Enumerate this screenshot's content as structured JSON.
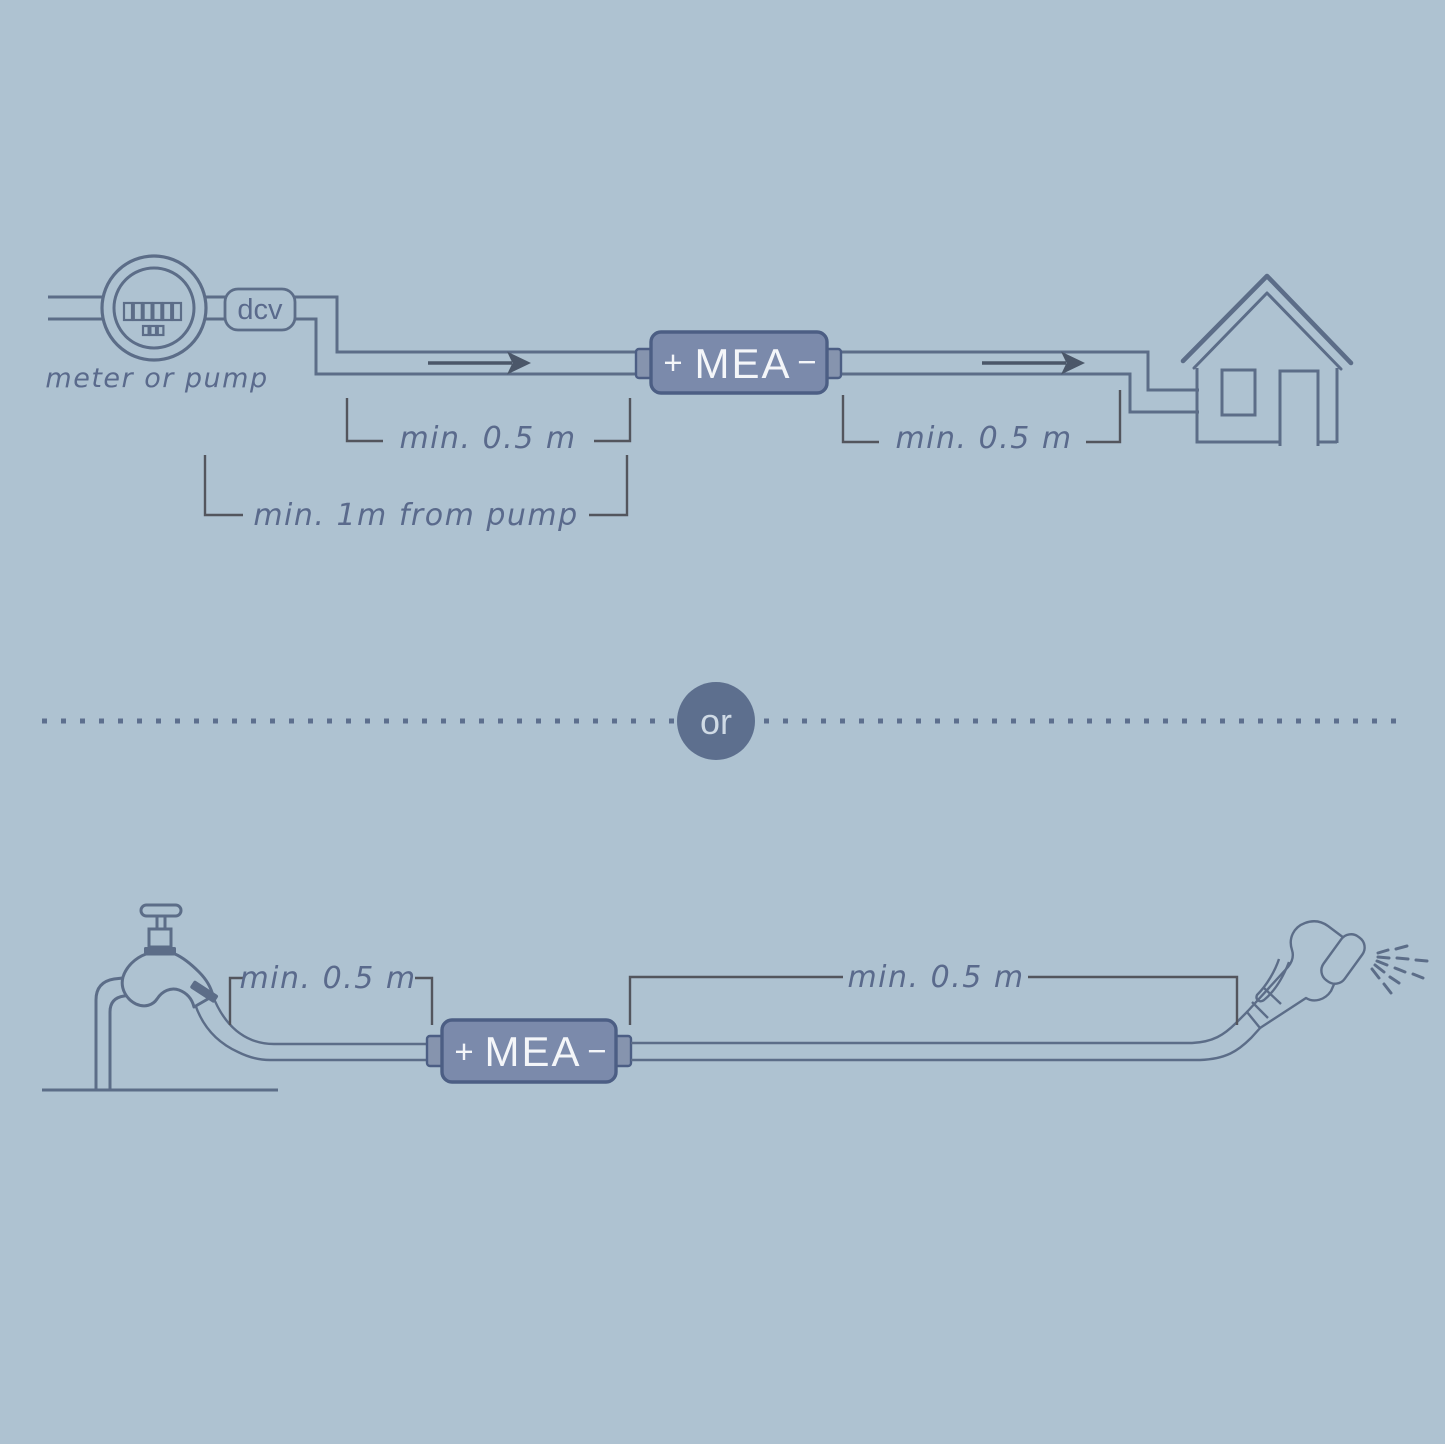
{
  "colors": {
    "background": "#aec2d1",
    "line": "#5c6d88",
    "bracket": "#53555d",
    "label": "#5a6a8c",
    "device_fill": "#7b8aab",
    "device_border": "#4c5e84",
    "connector_fill": "#8694ae",
    "device_text": "#f4f6f9",
    "arrow": "#4b5769",
    "or_circle": "#5d6f8e",
    "or_text": "#cfdae5"
  },
  "top_diagram": {
    "source_label": "meter or pump",
    "valve_label": "dcv",
    "device": {
      "plus": "+",
      "name": "MEA",
      "minus": "−"
    },
    "distance_before": "min. 0.5 m",
    "distance_after": "min. 0.5 m",
    "pump_distance": "min. 1m from pump",
    "icons": [
      "water-meter-icon",
      "double-check-valve-icon",
      "flow-arrow-icon",
      "mea-device",
      "flow-arrow-icon",
      "house-icon"
    ]
  },
  "divider": {
    "or_label": "or"
  },
  "bottom_diagram": {
    "device": {
      "plus": "+",
      "name": "MEA",
      "minus": "−"
    },
    "distance_before": "min. 0.5 m",
    "distance_after": "min. 0.5 m",
    "icons": [
      "tap-icon",
      "hose-icon",
      "mea-device",
      "spray-gun-icon"
    ]
  }
}
